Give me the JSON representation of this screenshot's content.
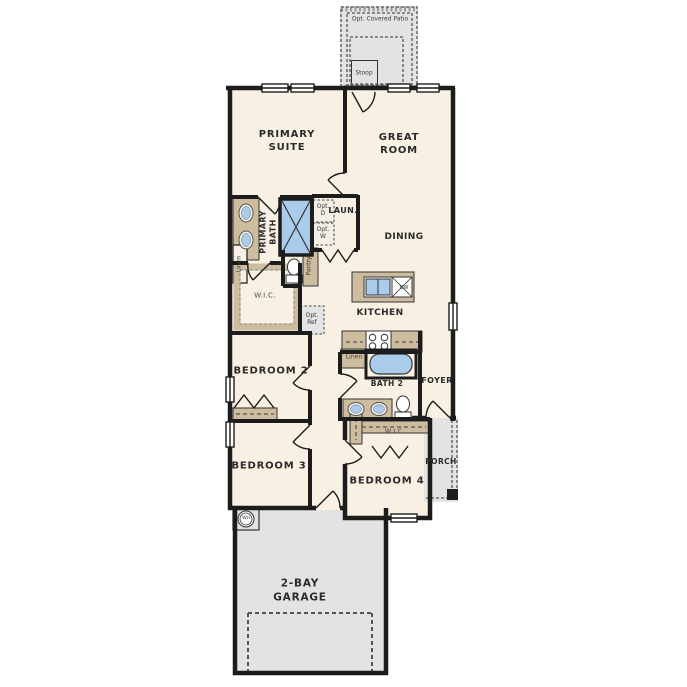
{
  "colors": {
    "wall": "#1c1c1c",
    "floor": "#f8f0e2",
    "outdoor": "#e3e3e3",
    "cabinet": "#cdbc9e",
    "water": "#aacbea"
  },
  "labels": {
    "patio": "Opt. Covered Patio",
    "stoop": "Stoop",
    "primary_suite": "PRIMARY\nSUITE",
    "great_room": "GREAT\nROOM",
    "primary_bath": "PRIMARY\nBATH",
    "laundry": "LAUN.",
    "opt_d": "Opt.\nD",
    "opt_w": "Opt.\nW",
    "linen_primary": "Linen",
    "pantry": "Pantry",
    "dining": "DINING",
    "wic_primary": "W.I.C.",
    "opt_ref": "Opt.\nRef",
    "kitchen": "KITCHEN",
    "dw": "DW",
    "bedroom2": "BEDROOM 2",
    "linen_bath2": "Linen",
    "bath2": "BATH 2",
    "foyer": "FOYER",
    "bedroom3": "BEDROOM 3",
    "bedroom4": "BEDROOM 4",
    "wic_bedroom4": "W.I.C.",
    "porch": "PORCH",
    "garage": "2-BAY\nGARAGE",
    "wh": "WH"
  }
}
